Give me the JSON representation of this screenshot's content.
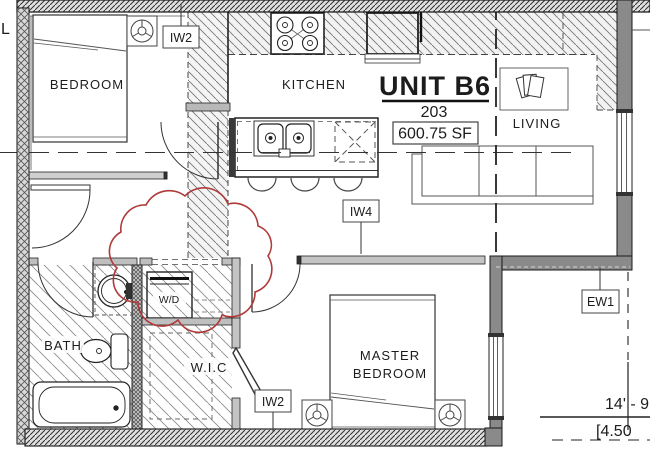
{
  "drawing": {
    "partial_left_label": "L",
    "unit": {
      "title": "UNIT B6",
      "number": "203",
      "area": "600.75 SF"
    },
    "rooms": {
      "bedroom": "BEDROOM",
      "kitchen": "KITCHEN",
      "living": "LIVING",
      "bath": "BATH",
      "wic": "W.I.C",
      "master_line1": "MASTER",
      "master_line2": "BEDROOM",
      "washer_dryer": "W/D"
    },
    "wall_tags": {
      "iw2_top": "IW2",
      "iw4": "IW4",
      "iw2_bottom": "IW2",
      "ew1": "EW1"
    },
    "dimensions": {
      "imperial": "14' - 9",
      "metric": "[4.50"
    },
    "colors": {
      "revision_cloud": "#b03a3a",
      "exterior_wall": "#8a8a8a"
    }
  }
}
